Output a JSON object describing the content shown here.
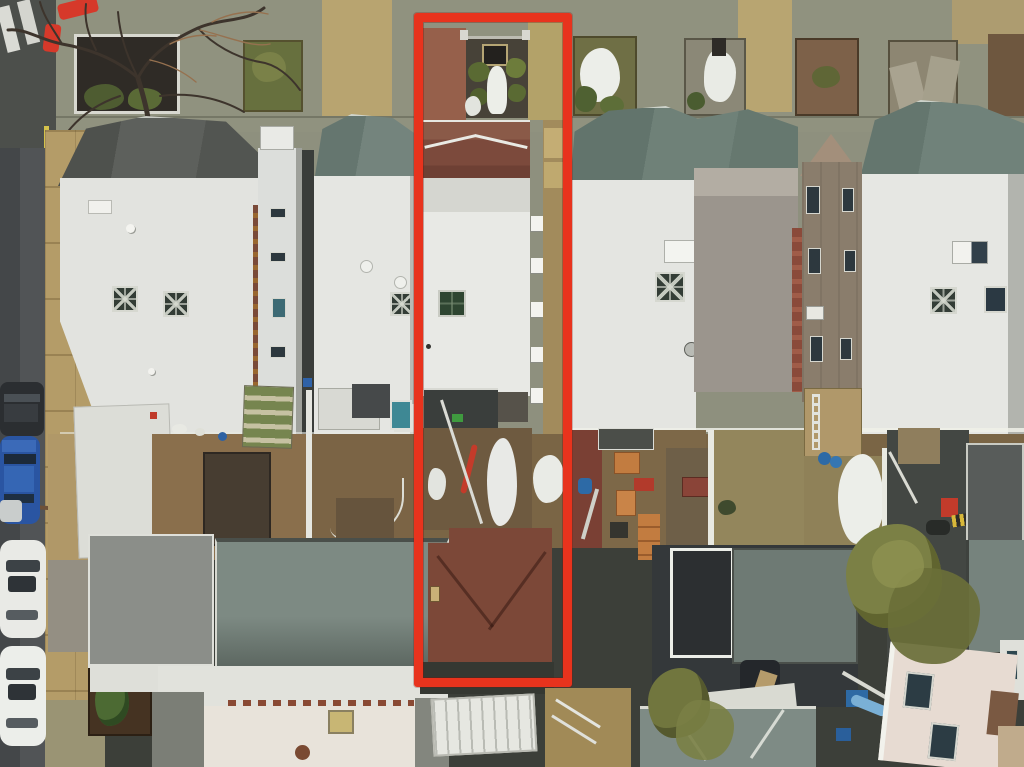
{
  "scene": {
    "type": "aerial-drone-photograph",
    "view": "top-down",
    "description": "Overhead view of a residential city block: a street with parked cars on the left, a row of flat-roofed attached rowhouses across the top, cluttered winter backyards in the middle, and a second row of pitched-roof houses at the bottom. A red rectangle outlines the narrow subject property lot from the front sidewalk to the rear house.",
    "season_cues": [
      "snow patches",
      "bare tree branches",
      "muddy yards"
    ]
  },
  "annotation": {
    "name": "property-boundary-highlight",
    "shape": "rectangle",
    "purpose": "marks the subject property lot",
    "color": "#e8331d"
  },
  "colors": {
    "highlight_red": "#e8331d",
    "pavement": "#8e907e",
    "asphalt": "#515456",
    "sidewalk_tan": "#b49c68",
    "roof_white": "#e6e7e3",
    "roof_teal": "#6e7f77",
    "mansard_gray": "#595c58",
    "subject_front_brown": "#7c4a3c",
    "subject_rear_roof": "#7c4838",
    "yard_dirt": "#8a6f4c",
    "snow_white": "#eceee9",
    "foliage_olive": "#71763e",
    "car_blue": "#2a55a2",
    "car_white": "#e9eae6",
    "charcoal_roof": "#34383a",
    "pink_building": "#e7dbd2"
  },
  "elements": {
    "street": "asphalt street with crosswalk stripes, left edge",
    "parked_cars": [
      "dark sedan",
      "blue sedan",
      "white sedan",
      "white sedan"
    ],
    "front_gardens": "small fenced garden beds with snow and shrubs along top sidewalk",
    "rowhouses": "white flat roofs with dark and teal mansard fronts, skylights with X-frames",
    "subject_house": "brown-front rowhouse inside red outline with white flat roof and green skylight",
    "backyards": "patios with furniture, tarps, awning, snow patches",
    "rear_houses": "hip-roofed houses, white roofs, rust-shingled subject rear house",
    "pergola": "white lattice pergola over dark roof",
    "trees": [
      "bare winter tree over sidewalk",
      "olive shrub trees in rear yards",
      "conifer bush"
    ]
  }
}
